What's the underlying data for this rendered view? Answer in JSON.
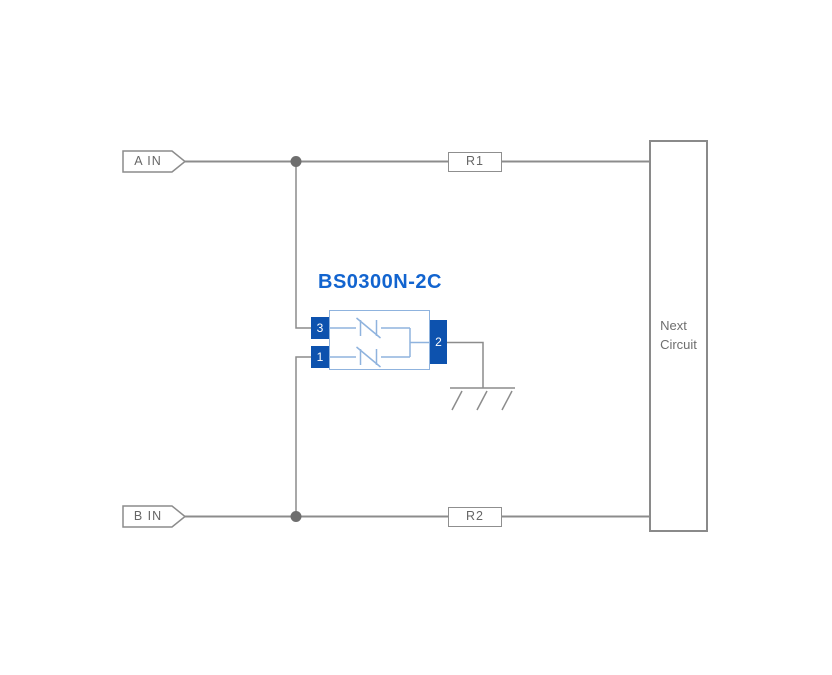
{
  "diagram": {
    "kind": "esd-protection-circuit-schematic",
    "inputs": {
      "a": {
        "label": "A IN"
      },
      "b": {
        "label": "B IN"
      }
    },
    "resistors": {
      "r1": {
        "label": "R1"
      },
      "r2": {
        "label": "R2"
      }
    },
    "component": {
      "name": "BS0300N-2C",
      "pin_top_left": "3",
      "pin_bottom_left": "1",
      "pin_right": "2",
      "internal_symbol": "bidirectional-tvs-diode-icon"
    },
    "next_circuit": {
      "line1": "Next",
      "line2": "Circuit"
    },
    "ground": {
      "icon": "chassis-ground-icon"
    },
    "colors": {
      "background": "#ffffff",
      "wire": "#8c8c8c",
      "junction_dot": "#6e6e6e",
      "box_border": "#8f8f8f",
      "label_text": "#666666",
      "component_accent": "#1264cf",
      "pin_fill": "#0d52ae",
      "component_outline": "#8fb3de"
    }
  }
}
